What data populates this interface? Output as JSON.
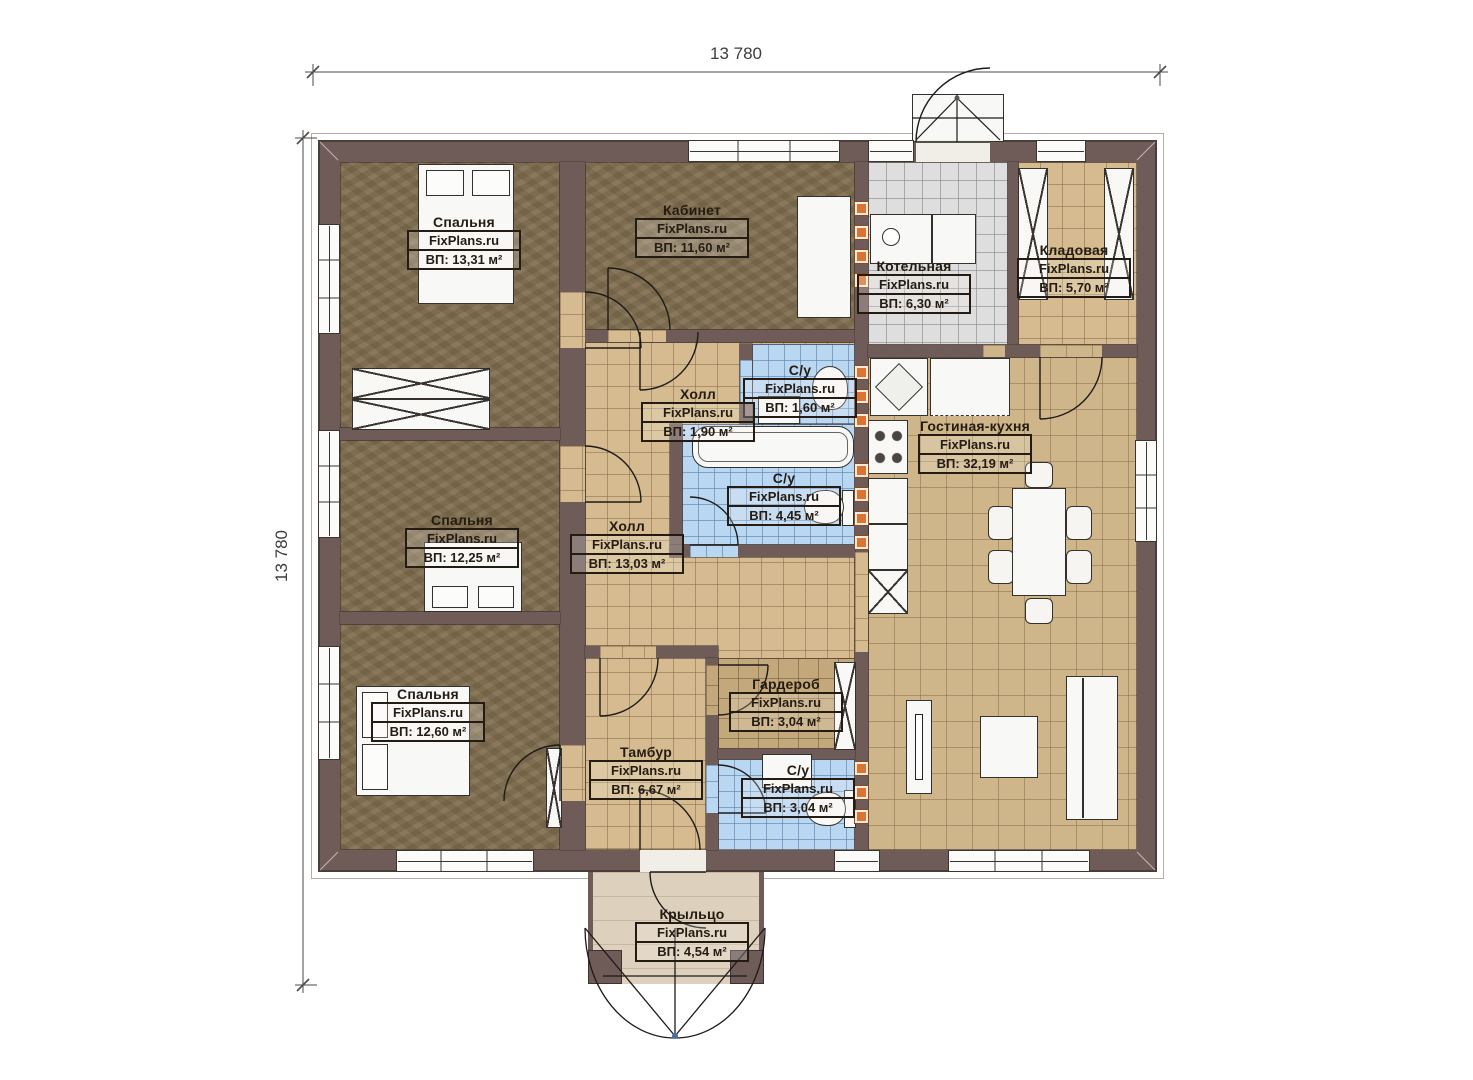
{
  "dimensions": {
    "top": "13 780",
    "left": "13 780"
  },
  "watermark": "FixPlans.ru",
  "rooms": [
    {
      "id": "bedroom-top-left",
      "name": "Спальня",
      "area": "ВП: 13,31 м²"
    },
    {
      "id": "bedroom-middle-left",
      "name": "Спальня",
      "area": "ВП: 12,25 м²"
    },
    {
      "id": "bedroom-bottom-left",
      "name": "Спальня",
      "area": "ВП: 12,60 м²"
    },
    {
      "id": "study",
      "name": "Кабинет",
      "area": "ВП: 11,60 м²"
    },
    {
      "id": "boiler-room",
      "name": "Котельная",
      "area": "ВП: 6,30 м²"
    },
    {
      "id": "storage",
      "name": "Кладовая",
      "area": "ВП: 5,70 м²"
    },
    {
      "id": "wc-small",
      "name": "С/у",
      "area": "ВП: 1,60 м²"
    },
    {
      "id": "hall-small",
      "name": "Холл",
      "area": "ВП: 1,90 м²"
    },
    {
      "id": "wc-main",
      "name": "С/у",
      "area": "ВП: 4,45 м²"
    },
    {
      "id": "living-kitchen",
      "name": "Гостиная-кухня",
      "area": "ВП: 32,19 м²"
    },
    {
      "id": "hall-main",
      "name": "Холл",
      "area": "ВП: 13,03 м²"
    },
    {
      "id": "wardrobe",
      "name": "Гардероб",
      "area": "ВП: 3,04 м²"
    },
    {
      "id": "vestibule",
      "name": "Тамбур",
      "area": "ВП: 6,67 м²"
    },
    {
      "id": "wc-bottom",
      "name": "С/у",
      "area": "ВП: 3,04 м²"
    },
    {
      "id": "porch",
      "name": "Крыльцо",
      "area": "ВП: 4,54 м²"
    }
  ],
  "colors": {
    "wall": "#6f5c59",
    "floor_brown": "#7d6c4f",
    "tile_tan": "#d5bb8f",
    "tile_grey": "#dedede",
    "tile_blue": "#bad7f2",
    "vent_orange": "#dd7330"
  }
}
